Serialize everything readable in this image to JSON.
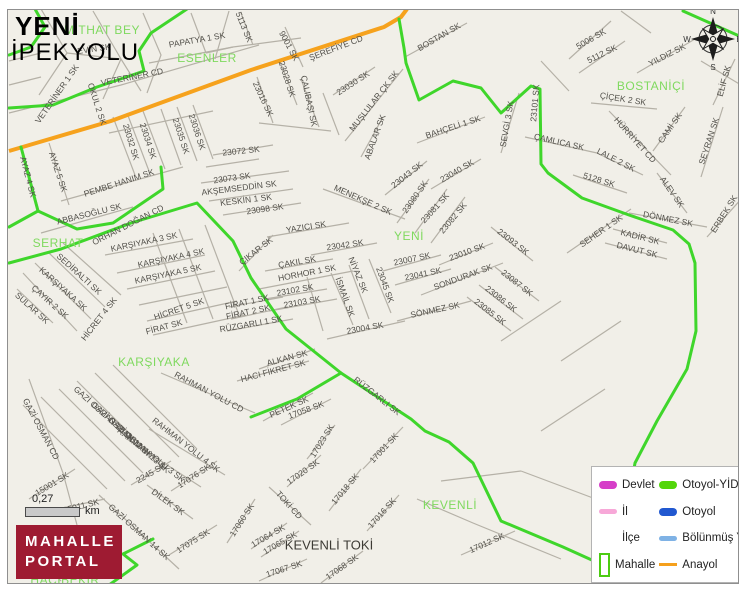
{
  "title": {
    "line1": "YENİ",
    "line2": "İPEKYOLU"
  },
  "logo": {
    "line1": "MAHALLE",
    "line2": "PORTAL"
  },
  "scale": {
    "value": "0,27",
    "unit": "km"
  },
  "compass": {
    "n": "N",
    "e": "E",
    "s": "S",
    "w": "W"
  },
  "colors": {
    "background": "#f1efe8",
    "minor_road": "#b5b1a7",
    "boundary_green": "#3fd62b",
    "anayol_orange": "#f6a21d",
    "district_green": "#7fd95f",
    "logo_red": "#9e1b32",
    "street_label": "#52504a"
  },
  "legend": {
    "columns": [
      [
        {
          "label": "Devlet",
          "swatch": "pill",
          "color": "#d63ec8",
          "icon": "devlet-line-swatch"
        },
        {
          "label": "İl",
          "swatch": "pill-thin",
          "color": "#f7a8d8",
          "icon": "il-line-swatch"
        },
        {
          "label": "İlçe",
          "swatch": "none",
          "color": "",
          "icon": "ilce-swatch"
        },
        {
          "label": "Mahalle",
          "swatch": "rect",
          "color": "#4ccc12",
          "icon": "mahalle-rect-swatch"
        }
      ],
      [
        {
          "label": "Otoyol-YİD",
          "swatch": "pill",
          "color": "#52d60a",
          "icon": "otoyol-yid-line-swatch"
        },
        {
          "label": "Otoyol",
          "swatch": "pill",
          "color": "#2158d0",
          "icon": "otoyol-line-swatch"
        },
        {
          "label": "Bölünmüş Y",
          "swatch": "pill-thin",
          "color": "#7fb2e5",
          "icon": "bolunmus-yol-line-swatch"
        },
        {
          "label": "Anayol",
          "swatch": "thin",
          "color": "#f5a01c",
          "icon": "anayol-line-swatch"
        }
      ]
    ]
  },
  "map": {
    "districts": [
      {
        "t": "MİTHAT BEY",
        "x": 101,
        "y": 29
      },
      {
        "t": "ESENLER",
        "x": 206,
        "y": 57
      },
      {
        "t": "BOSTANİÇİ",
        "x": 650,
        "y": 85
      },
      {
        "t": "SERHAT",
        "x": 57,
        "y": 242
      },
      {
        "t": "YENİ",
        "x": 408,
        "y": 235
      },
      {
        "t": "KARŞIYAKA",
        "x": 153,
        "y": 361
      },
      {
        "t": "KEVENLİ",
        "x": 449,
        "y": 504
      },
      {
        "t": "HACIBEKİR",
        "x": 64,
        "y": 579
      }
    ],
    "places": [
      {
        "t": "KEVENLİ TOKİ",
        "x": 328,
        "y": 544
      }
    ],
    "streets": [
      {
        "t": "EVİN SK",
        "x": 93,
        "y": 48,
        "r": -8
      },
      {
        "t": "PAPATYA 1 SK",
        "x": 196,
        "y": 39,
        "r": -10
      },
      {
        "t": "VETERİNER 1 SK",
        "x": 56,
        "y": 93,
        "r": -55
      },
      {
        "t": "VETERİNER CD",
        "x": 131,
        "y": 76,
        "r": -11
      },
      {
        "t": "OKUL 2 SK",
        "x": 96,
        "y": 103,
        "r": 72
      },
      {
        "t": "5113 SK",
        "x": 243,
        "y": 26,
        "r": 68
      },
      {
        "t": "9001 SK",
        "x": 288,
        "y": 45,
        "r": 62
      },
      {
        "t": "ŞEREFİYE CD",
        "x": 335,
        "y": 47,
        "r": -21
      },
      {
        "t": "23028 SK",
        "x": 286,
        "y": 78,
        "r": 72
      },
      {
        "t": "23016 SK",
        "x": 262,
        "y": 98,
        "r": 65
      },
      {
        "t": "ÇALIBAŞI SK",
        "x": 308,
        "y": 100,
        "r": 78
      },
      {
        "t": "23030 SK",
        "x": 352,
        "y": 82,
        "r": -33
      },
      {
        "t": "MUŞLULAR ÇK SK",
        "x": 373,
        "y": 100,
        "r": -52
      },
      {
        "t": "BOSTAN SK",
        "x": 438,
        "y": 36,
        "r": -30
      },
      {
        "t": "ABALAR SK",
        "x": 374,
        "y": 136,
        "r": -70
      },
      {
        "t": "BAHÇELİ 1 SK",
        "x": 452,
        "y": 126,
        "r": -18
      },
      {
        "t": "23043 SK",
        "x": 406,
        "y": 174,
        "r": -38
      },
      {
        "t": "23040 SK",
        "x": 456,
        "y": 170,
        "r": -30
      },
      {
        "t": "23080 SK",
        "x": 414,
        "y": 196,
        "r": -55
      },
      {
        "t": "23081 SK",
        "x": 434,
        "y": 207,
        "r": -48
      },
      {
        "t": "23082 SK",
        "x": 452,
        "y": 217,
        "r": -50
      },
      {
        "t": "MENEKŞE 2 SK",
        "x": 362,
        "y": 199,
        "r": 24
      },
      {
        "t": "AKŞEMSEDDİN SK",
        "x": 238,
        "y": 187,
        "r": -7
      },
      {
        "t": "KESKİN 1 SK",
        "x": 245,
        "y": 199,
        "r": -7
      },
      {
        "t": "23098 SK",
        "x": 264,
        "y": 208,
        "r": -8
      },
      {
        "t": "23072 SK",
        "x": 240,
        "y": 150,
        "r": -6
      },
      {
        "t": "23073 SK",
        "x": 231,
        "y": 177,
        "r": -8
      },
      {
        "t": "YAZICI SK",
        "x": 305,
        "y": 226,
        "r": -9
      },
      {
        "t": "23042 SK",
        "x": 344,
        "y": 244,
        "r": -8
      },
      {
        "t": "ÇAKIL SK",
        "x": 296,
        "y": 261,
        "r": -10
      },
      {
        "t": "ÇIKAR SK",
        "x": 255,
        "y": 250,
        "r": -38
      },
      {
        "t": "23007 SK",
        "x": 411,
        "y": 258,
        "r": -12
      },
      {
        "t": "23041 SK",
        "x": 422,
        "y": 273,
        "r": -12
      },
      {
        "t": "23010 SK",
        "x": 466,
        "y": 251,
        "r": -20
      },
      {
        "t": "SONDURAK SK",
        "x": 462,
        "y": 276,
        "r": -20
      },
      {
        "t": "SÖNMEZ SK",
        "x": 434,
        "y": 309,
        "r": -12
      },
      {
        "t": "23045 SK",
        "x": 384,
        "y": 284,
        "r": 70
      },
      {
        "t": "NİYAZ SK",
        "x": 357,
        "y": 274,
        "r": 68
      },
      {
        "t": "İSMAİL SK",
        "x": 344,
        "y": 296,
        "r": 70
      },
      {
        "t": "HORHOR 1 SK",
        "x": 306,
        "y": 272,
        "r": -11
      },
      {
        "t": "23102 SK",
        "x": 294,
        "y": 289,
        "r": -10
      },
      {
        "t": "23103 SK",
        "x": 301,
        "y": 301,
        "r": -10
      },
      {
        "t": "23004 SK",
        "x": 364,
        "y": 327,
        "r": -10
      },
      {
        "t": "FİRAT 1 SK",
        "x": 246,
        "y": 301,
        "r": -12
      },
      {
        "t": "FİRAT 2 SK",
        "x": 247,
        "y": 311,
        "r": -12
      },
      {
        "t": "RÜZGARLI 1 SK",
        "x": 250,
        "y": 323,
        "r": -10
      },
      {
        "t": "FİRAT SK",
        "x": 163,
        "y": 326,
        "r": -15
      },
      {
        "t": "HİCRET 5 SK",
        "x": 178,
        "y": 308,
        "r": -19
      },
      {
        "t": "HİCRET 4 SK",
        "x": 98,
        "y": 318,
        "r": -52
      },
      {
        "t": "SULAR SK",
        "x": 31,
        "y": 307,
        "r": 42
      },
      {
        "t": "SEDİRALTI SK",
        "x": 78,
        "y": 273,
        "r": 42
      },
      {
        "t": "KARŞIYAKA SK",
        "x": 62,
        "y": 288,
        "r": 42
      },
      {
        "t": "ÇAYIR 2 SK",
        "x": 49,
        "y": 301,
        "r": 42
      },
      {
        "t": "KARŞIYAKA 3 SK",
        "x": 143,
        "y": 241,
        "r": -12
      },
      {
        "t": "KARŞIYAKA 4 SK",
        "x": 170,
        "y": 257,
        "r": -12
      },
      {
        "t": "KARŞIYAKA 5 SK",
        "x": 167,
        "y": 273,
        "r": -12
      },
      {
        "t": "ORHAN DOĞAN CD",
        "x": 127,
        "y": 224,
        "r": -27
      },
      {
        "t": "ABBASOĞLU SK",
        "x": 88,
        "y": 213,
        "r": -14
      },
      {
        "t": "PEMBE HANIM SK",
        "x": 118,
        "y": 182,
        "r": -18
      },
      {
        "t": "AYAZ 4 SK",
        "x": 27,
        "y": 176,
        "r": 75
      },
      {
        "t": "AYAZ 5 SK",
        "x": 57,
        "y": 171,
        "r": 72
      },
      {
        "t": "23032 SK",
        "x": 130,
        "y": 141,
        "r": 73
      },
      {
        "t": "23034 SK",
        "x": 147,
        "y": 140,
        "r": 72
      },
      {
        "t": "23035 SK",
        "x": 180,
        "y": 135,
        "r": 72
      },
      {
        "t": "23036 SK",
        "x": 196,
        "y": 131,
        "r": 72
      },
      {
        "t": "ALKAN SK",
        "x": 286,
        "y": 357,
        "r": -15
      },
      {
        "t": "HACI FİKRET SK",
        "x": 272,
        "y": 370,
        "r": -15
      },
      {
        "t": "RÜZGARLI SK",
        "x": 376,
        "y": 395,
        "r": 38
      },
      {
        "t": "PETEK SK",
        "x": 288,
        "y": 406,
        "r": -24
      },
      {
        "t": "17058 SK",
        "x": 305,
        "y": 409,
        "r": -20
      },
      {
        "t": "17023 SK",
        "x": 321,
        "y": 440,
        "r": -58
      },
      {
        "t": "17001 SK",
        "x": 383,
        "y": 447,
        "r": -47
      },
      {
        "t": "17020 SK",
        "x": 302,
        "y": 471,
        "r": -35
      },
      {
        "t": "TOKİ CD",
        "x": 288,
        "y": 504,
        "r": 48
      },
      {
        "t": "17018 SK",
        "x": 344,
        "y": 488,
        "r": -50
      },
      {
        "t": "17016 SK",
        "x": 381,
        "y": 512,
        "r": -48
      },
      {
        "t": "17064 SK",
        "x": 267,
        "y": 535,
        "r": -30
      },
      {
        "t": "17065 SK",
        "x": 279,
        "y": 542,
        "r": -30
      },
      {
        "t": "17067 SK",
        "x": 283,
        "y": 568,
        "r": -18
      },
      {
        "t": "17068 SK",
        "x": 341,
        "y": 566,
        "r": -35
      },
      {
        "t": "17012 SK",
        "x": 486,
        "y": 542,
        "r": -24
      },
      {
        "t": "17060 SK",
        "x": 241,
        "y": 519,
        "r": -57
      },
      {
        "t": "DİLEK SK",
        "x": 167,
        "y": 501,
        "r": 36
      },
      {
        "t": "17076 SK",
        "x": 193,
        "y": 475,
        "r": -33
      },
      {
        "t": "17075 SK",
        "x": 192,
        "y": 540,
        "r": -32
      },
      {
        "t": "GAZİ OSMAN 14 SK",
        "x": 138,
        "y": 531,
        "r": 42
      },
      {
        "t": "2245 SK",
        "x": 150,
        "y": 472,
        "r": -30
      },
      {
        "t": "RAHMAN YOLU CD",
        "x": 208,
        "y": 391,
        "r": 28
      },
      {
        "t": "RAHMAN YOLU 3 SK",
        "x": 150,
        "y": 454,
        "r": 38
      },
      {
        "t": "RAHMAN YOLU 4 SK",
        "x": 185,
        "y": 444,
        "r": 38
      },
      {
        "t": "GAZİ OSMAN 11 SK",
        "x": 103,
        "y": 413,
        "r": 42
      },
      {
        "t": "GAZİ OSMAN 12 SK",
        "x": 121,
        "y": 429,
        "r": 42
      },
      {
        "t": "GAZİ OSMAN 13 SK",
        "x": 138,
        "y": 444,
        "r": 42
      },
      {
        "t": "GAZİ OSMAN CD",
        "x": 40,
        "y": 428,
        "r": 62
      },
      {
        "t": "15001 SK",
        "x": 51,
        "y": 483,
        "r": -31
      },
      {
        "t": "15011 SK",
        "x": 80,
        "y": 505,
        "r": -14
      },
      {
        "t": "SEVGİ 3 SK",
        "x": 506,
        "y": 123,
        "r": -80
      },
      {
        "t": "23101 SK",
        "x": 534,
        "y": 102,
        "r": -85
      },
      {
        "t": "ÇAMLICA SK",
        "x": 558,
        "y": 141,
        "r": 13
      },
      {
        "t": "LALE 2 SK",
        "x": 615,
        "y": 159,
        "r": 27
      },
      {
        "t": "5128 SK",
        "x": 598,
        "y": 179,
        "r": 17
      },
      {
        "t": "HÜRRİYET CD",
        "x": 634,
        "y": 139,
        "r": 48
      },
      {
        "t": "CAMİ SK",
        "x": 669,
        "y": 127,
        "r": -55
      },
      {
        "t": "SEYRAN SK",
        "x": 708,
        "y": 140,
        "r": -72
      },
      {
        "t": "ALEV SK",
        "x": 671,
        "y": 191,
        "r": 55
      },
      {
        "t": "ERBEK SK",
        "x": 723,
        "y": 213,
        "r": -58
      },
      {
        "t": "ELİF SK",
        "x": 723,
        "y": 80,
        "r": -75
      },
      {
        "t": "YILDIZ SK",
        "x": 666,
        "y": 54,
        "r": -27
      },
      {
        "t": "5006 SK",
        "x": 590,
        "y": 38,
        "r": -30
      },
      {
        "t": "5112 SK",
        "x": 601,
        "y": 53,
        "r": -26
      },
      {
        "t": "ÇİÇEK 2 SK",
        "x": 622,
        "y": 98,
        "r": 9
      },
      {
        "t": "DÖNMEZ SK",
        "x": 667,
        "y": 218,
        "r": 11
      },
      {
        "t": "SEHER 1 SK",
        "x": 600,
        "y": 230,
        "r": -35
      },
      {
        "t": "KADİR SK",
        "x": 639,
        "y": 236,
        "r": 14
      },
      {
        "t": "DAVUT SK",
        "x": 636,
        "y": 249,
        "r": 14
      },
      {
        "t": "23093 SK",
        "x": 512,
        "y": 241,
        "r": 38
      },
      {
        "t": "23087 SK",
        "x": 516,
        "y": 282,
        "r": 38
      },
      {
        "t": "23086 SK",
        "x": 500,
        "y": 298,
        "r": 38
      },
      {
        "t": "23085 SK",
        "x": 489,
        "y": 311,
        "r": 38
      }
    ]
  }
}
